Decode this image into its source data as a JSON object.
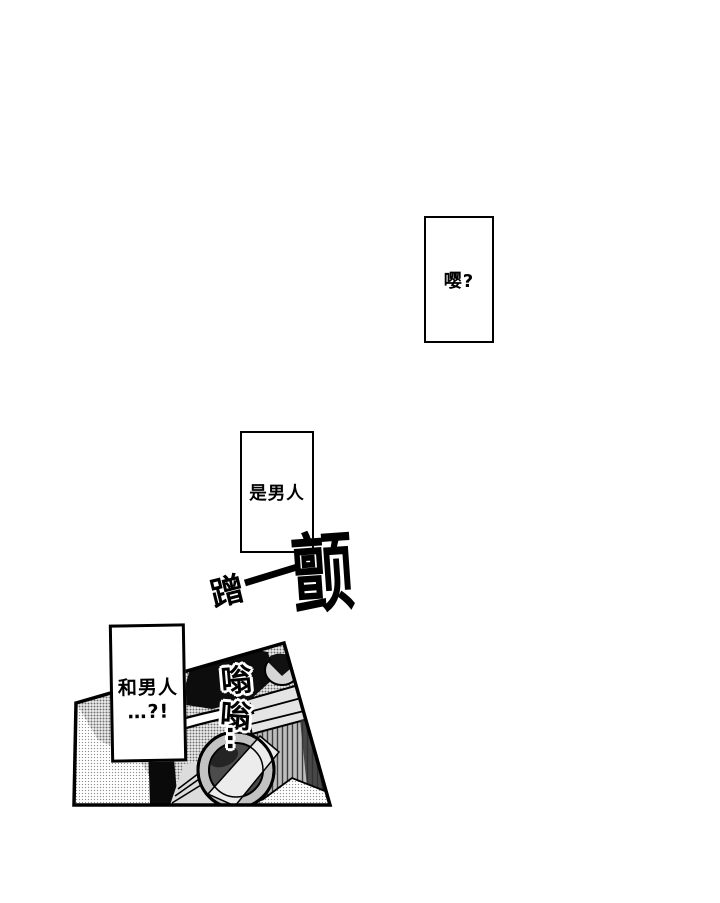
{
  "page": {
    "type": "manga page",
    "background": "#ffffff",
    "ink_color": "#000000"
  },
  "bubbles": {
    "bubble1": {
      "text": "嘤?"
    },
    "bubble2": {
      "text": "是男人"
    },
    "bubble3": {
      "line1": "和男人",
      "line2": "…?!"
    }
  },
  "sfx": {
    "ceng": "蹭",
    "yi": "一",
    "chan": "颤",
    "weng1": "嗡",
    "weng2": "嗡",
    "weng_dots": "…"
  },
  "panel": {
    "description": "tilted halftone panel showing a camera-like machine with large lens",
    "border_color": "#000000",
    "halftone_light_dot": "#8f8f8f",
    "halftone_medium_dot": "#6f6f6f"
  }
}
